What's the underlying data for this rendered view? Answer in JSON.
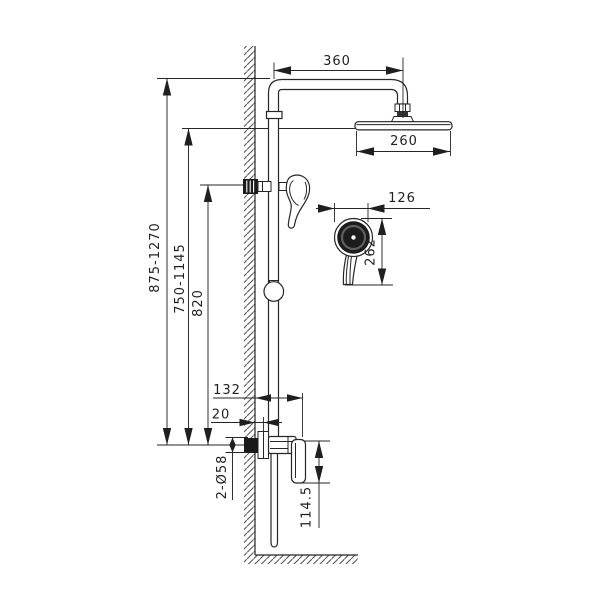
{
  "colors": {
    "line": "#262626",
    "hatch": "#4f4f4f",
    "dark_fill": "#1a1a1a",
    "arrow": "#1f1f1f",
    "background": "#ffffff"
  },
  "dimensions": {
    "arm_span": "360",
    "head_width": "260",
    "handset_width": "126",
    "handset_length": "262",
    "total_height_range": "875-1270",
    "head_height_range": "750-1145",
    "holder_height": "820",
    "valve_depth": "132",
    "wall_gap": "20",
    "escutcheon_spec": "2-Ø58",
    "valve_body_height": "114.5"
  }
}
